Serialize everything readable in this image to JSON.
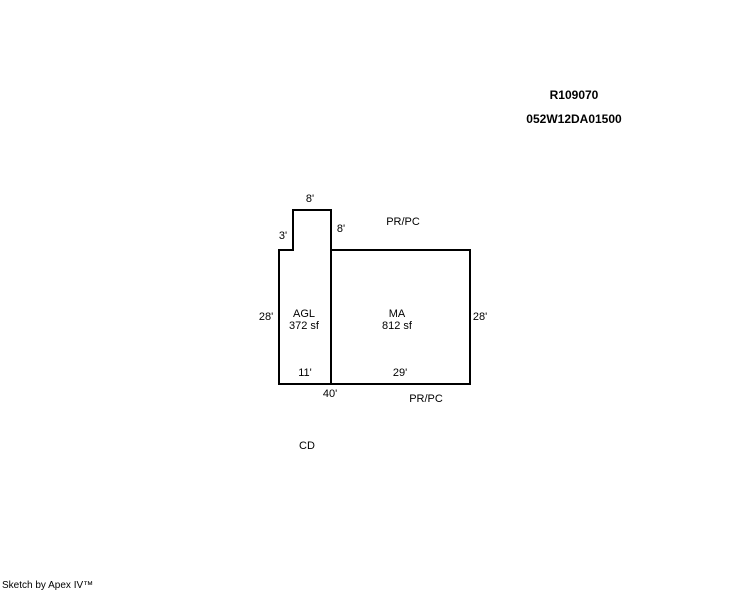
{
  "header": {
    "record_id": "R109070",
    "parcel_id": "052W12DA01500"
  },
  "sketch": {
    "dimensions": {
      "bump_top": "8'",
      "bump_left": "3'",
      "bump_right": "8'",
      "left_side": "28'",
      "right_side": "28'",
      "agl_bottom": "11'",
      "ma_bottom": "29'",
      "overall_bottom": "40'"
    },
    "areas": {
      "agl": {
        "code": "AGL",
        "size": "372 sf"
      },
      "ma": {
        "code": "MA",
        "size": "812 sf"
      }
    },
    "annotations": {
      "pr_pc_top": "PR/PC",
      "pr_pc_bottom": "PR/PC",
      "cd": "CD"
    },
    "colors": {
      "line": "#000000",
      "background": "#ffffff"
    }
  },
  "footer": {
    "credit": "Sketch by Apex IV™"
  }
}
